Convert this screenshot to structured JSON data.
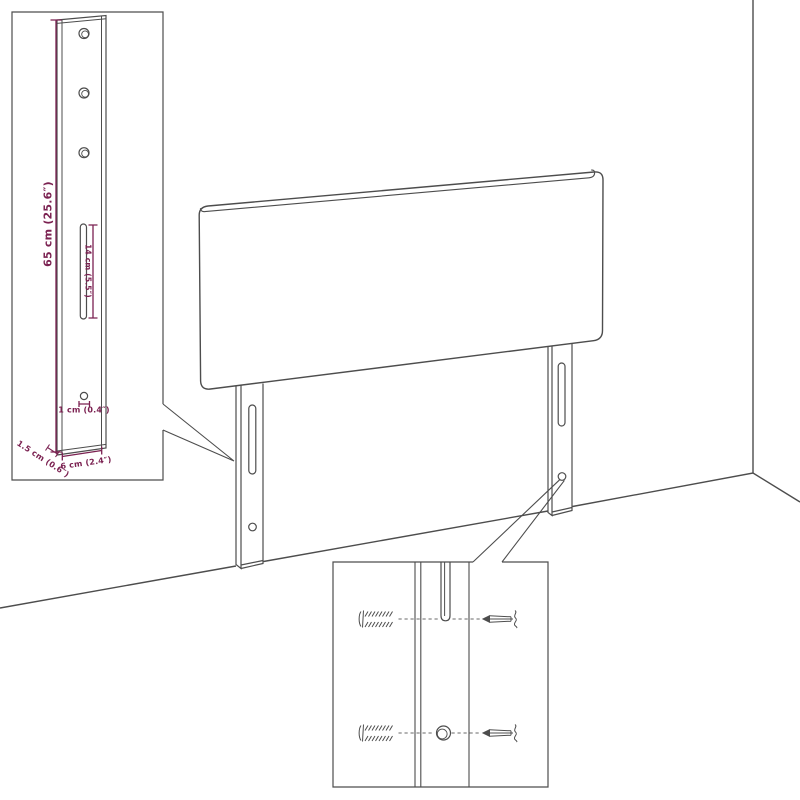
{
  "diagram": {
    "colors": {
      "line": "#4d4d4d",
      "dimension": "#7b2151",
      "background": "#ffffff"
    },
    "dimensions": {
      "leg_height": "65 cm (25.6″)",
      "slot_length": "14 cm (5.5″)",
      "hole_size": "1 cm (0.4″)",
      "leg_thickness": "1.5 cm (0.6″)",
      "leg_width": "6 cm (2.4″)"
    }
  }
}
